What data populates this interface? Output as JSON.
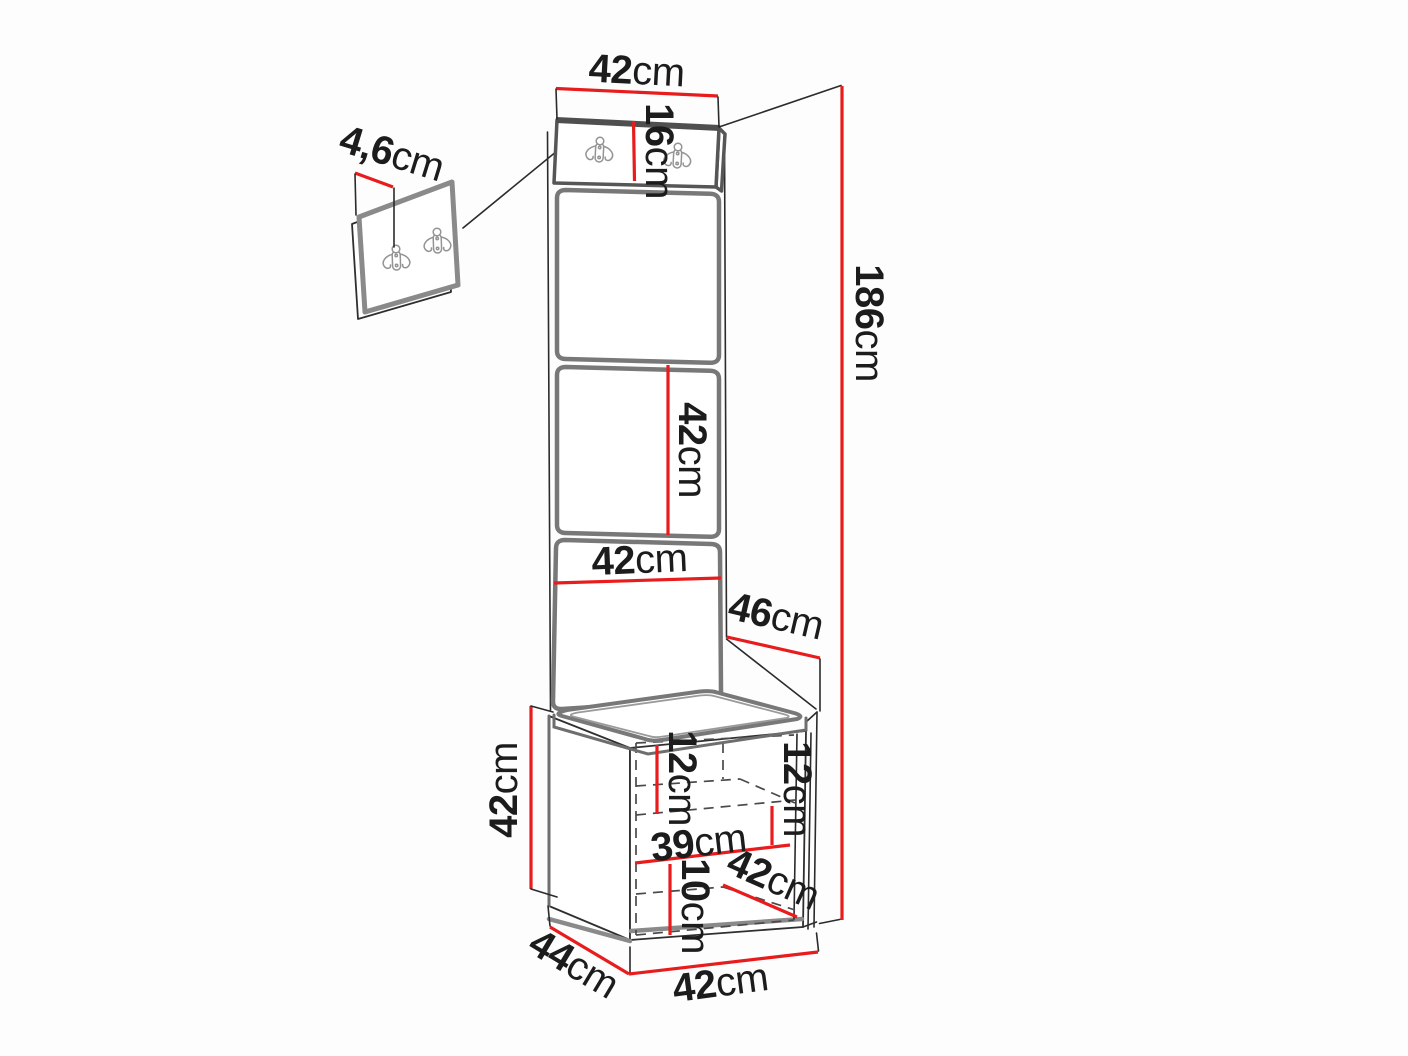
{
  "diagram": {
    "subject": "hallway furniture set dimension drawing: wall-mounted double-hook panel, tall upholstered panel with hook board, and shoe bench cabinet",
    "background_color": "#fdfdfd",
    "colors": {
      "dimension_line": "#e81c1c",
      "panel_outline": "#787878",
      "structure_line": "#2b2b2b",
      "dashed_line": "#4a4a4a",
      "text": "#1c1c1c"
    },
    "dimensions": {
      "top_width": {
        "value": "42",
        "unit": "cm"
      },
      "header_height": {
        "value": "16",
        "unit": "cm"
      },
      "wall_panel_thickness": {
        "value": "4,6",
        "unit": "cm"
      },
      "total_height": {
        "value": "186",
        "unit": "cm"
      },
      "panel_segment_height": {
        "value": "42",
        "unit": "cm"
      },
      "panel_width": {
        "value": "42",
        "unit": "cm"
      },
      "seat_depth": {
        "value": "46",
        "unit": "cm"
      },
      "bench_height": {
        "value": "42",
        "unit": "cm"
      },
      "shelf_top_left": {
        "value": "12",
        "unit": "cm"
      },
      "shelf_top_right": {
        "value": "12",
        "unit": "cm"
      },
      "inner_width": {
        "value": "39",
        "unit": "cm"
      },
      "shelf_bottom": {
        "value": "10",
        "unit": "cm"
      },
      "door_width": {
        "value": "42",
        "unit": "cm"
      },
      "base_depth": {
        "value": "44",
        "unit": "cm"
      },
      "base_width": {
        "value": "42",
        "unit": "cm"
      }
    }
  }
}
